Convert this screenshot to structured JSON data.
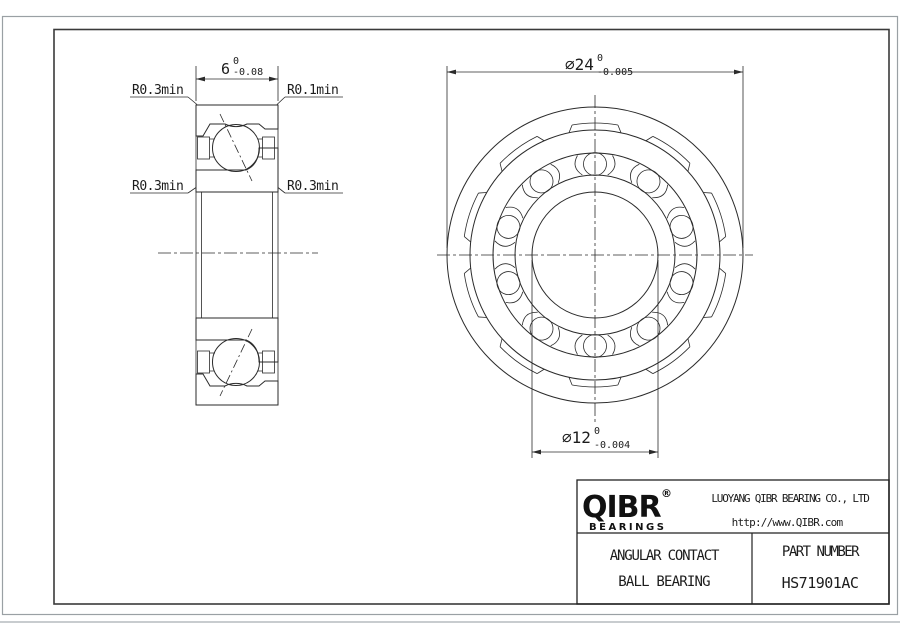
{
  "section_view": {
    "dim_width": {
      "value": "6",
      "tol_upper": "0",
      "tol_lower": "-0.08"
    },
    "label_top_left": "R0.3min",
    "label_top_right": "R0.1min",
    "label_mid_left": "R0.3min",
    "label_mid_right": "R0.3min"
  },
  "front_view": {
    "dim_outer_diameter": {
      "value": "⌀24",
      "tol_upper": "0",
      "tol_lower": "-0.005"
    },
    "dim_bore_diameter": {
      "value": "⌀12",
      "tol_upper": "0",
      "tol_lower": "-0.004"
    }
  },
  "title_block": {
    "logo_text": "QIBR",
    "logo_registered": "®",
    "logo_subtext": "BEARINGS",
    "company_name": "LUOYANG QIBR BEARING CO., LTD",
    "website": "http://www.QIBR.com",
    "product_name_line1": "ANGULAR CONTACT",
    "product_name_line2": "BALL BEARING",
    "part_number_label": "PART NUMBER",
    "part_number": "HS71901AC"
  },
  "colors": {
    "line": "#2b2b2b",
    "frame": "#3a3a3a",
    "page_border": "#9aa0a4",
    "background": "#ffffff"
  }
}
